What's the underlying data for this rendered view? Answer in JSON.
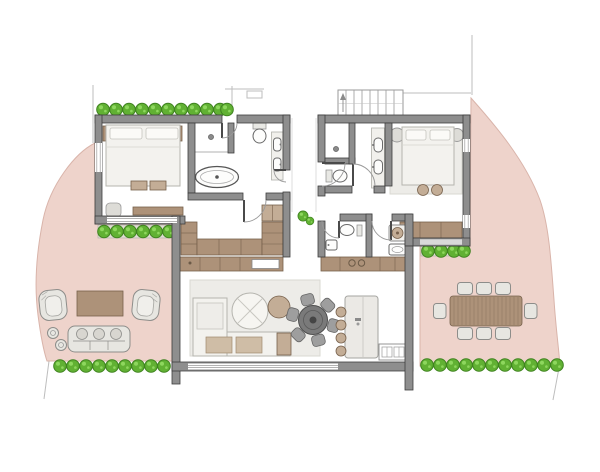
{
  "meta": {
    "label": "Residential floor plan with two bedroom suites, open living area and landscaped terraces",
    "text_visible": false
  },
  "palette": {
    "background": "#ffffff",
    "terrace_pink": "#eed3cb",
    "terrace_pink_edge": "#d9b4aa",
    "wall_fill": "#8e8e8e",
    "wall_edge": "#3e3e3e",
    "floor": "#ffffff",
    "rug": "#edece8",
    "furniture_light": "#f3f2ee",
    "furniture_light_edge": "#b5b4ae",
    "wood_brown": "#ad9279",
    "wood_brown_lite": "#c3ad96",
    "wood_brown_edge": "#77614c",
    "hedge_green": "#61b133",
    "hedge_green_edge": "#3f8220",
    "hedge_green_hi": "#8ed75e",
    "chair_gray": "#9e9e9e",
    "table_dark": "#7a7a7a",
    "site_line": "#bdbdbd"
  },
  "rooms": [
    {
      "id": "bedroom-1",
      "label": "west bedroom",
      "furniture": [
        "double bed",
        "2 nightstands",
        "2 bench cushions",
        "desk",
        "chair"
      ]
    },
    {
      "id": "bathroom-1",
      "label": "west bathroom",
      "furniture": [
        "freestanding bathtub",
        "walk-in shower",
        "wall-hung toilet",
        "double-sink vanity"
      ]
    },
    {
      "id": "walk-in-closet",
      "label": "walk-in closet",
      "furniture": [
        "left wardrobe",
        "back wardrobe",
        "right wardrobe",
        "upper cabinet"
      ]
    },
    {
      "id": "entry-vestibule",
      "label": "central entry vestibule",
      "furniture": [
        "2 planter shrubs"
      ]
    },
    {
      "id": "bathroom-2",
      "label": "east bathroom",
      "furniture": [
        "shower room",
        "wall-hung toilet",
        "double-sink vanity"
      ]
    },
    {
      "id": "bedroom-2",
      "label": "east bedroom",
      "furniture": [
        "double bed",
        "2 round side tables",
        "2 poufs",
        "wardrobe",
        "area rug"
      ]
    },
    {
      "id": "wc",
      "label": "guest WC",
      "furniture": [
        "wall-hung toilet",
        "washbasin"
      ]
    },
    {
      "id": "laundry",
      "label": "laundry room",
      "furniture": [
        "washing machine",
        "utility sink"
      ]
    },
    {
      "id": "living-room",
      "label": "living room",
      "furniture": [
        "L-shaped sofa",
        "round coffee table",
        "round side table",
        "area rug",
        "sideboard with fireplace insert"
      ]
    },
    {
      "id": "dining-area",
      "label": "dining area",
      "furniture": [
        "round dining table",
        "6 chairs"
      ]
    },
    {
      "id": "kitchen",
      "label": "kitchen",
      "furniture": [
        "island counter",
        "4 bar stools",
        "rear cabinet with cooktop",
        "double sink unit"
      ]
    }
  ],
  "outdoor": {
    "west_terrace": {
      "furniture": [
        "2 wicker armchairs",
        "coffee table",
        "outdoor sofa",
        "2 round side tables"
      ]
    },
    "east_terrace": {
      "furniture": [
        "slatted dining table",
        "8 chairs"
      ]
    },
    "exterior_staircase": {
      "treads": 7
    },
    "hedgerows": {
      "top_row": 10,
      "west_planter": 6,
      "bottom_west_row": 9,
      "bottom_east_row": 11,
      "east_planter": 4,
      "vestibule_shrubs": 2
    }
  }
}
